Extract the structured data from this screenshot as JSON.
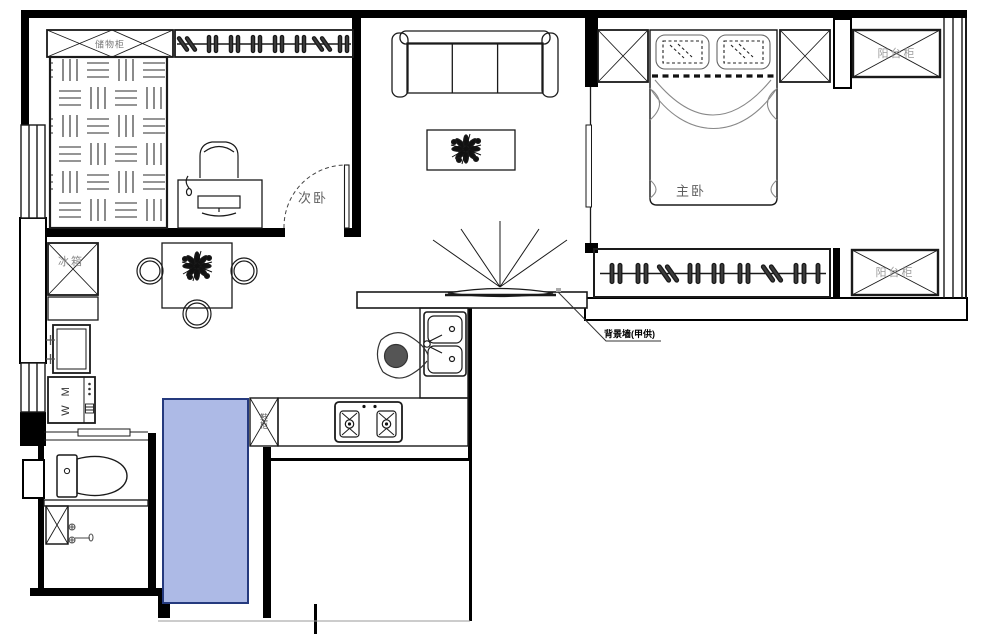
{
  "drawing": {
    "type": "apartment floor plan",
    "line_color": "#1a1a1a",
    "highlight_fill": "#adbae6",
    "highlight_border": "#253a7e"
  },
  "labels": {
    "storage_cabinet": "储物柜",
    "secondary_bedroom": "次卧",
    "master_bedroom": "主卧",
    "balcony_cabinet_top": "阳台柜",
    "balcony_cabinet_side": "阳台柜",
    "fridge": "冰箱",
    "shoe_cabinet": "鞋柜",
    "washing_machine": "W M",
    "tv_wall_note": "背景墙(甲供)"
  }
}
